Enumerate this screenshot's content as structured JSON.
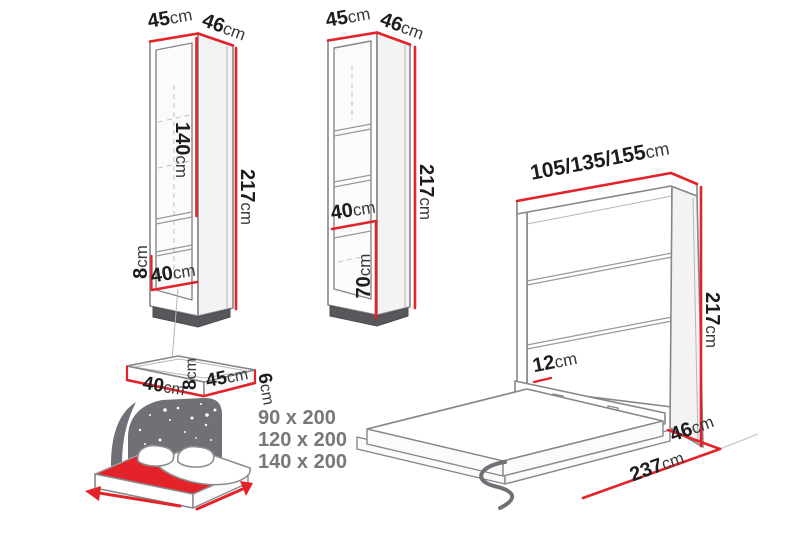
{
  "diagram_title": "wall-bed-and-cabinets-dimensions",
  "colors": {
    "dimension_red": "#e32329",
    "outline_gray": "#85878a",
    "text_dark": "#1d1d1f",
    "headboard_gray": "#6f7176",
    "size_list_gray": "#77787b"
  },
  "labels": {
    "cabinet_closed": {
      "top_width": {
        "value": "45",
        "unit": "cm"
      },
      "top_depth": {
        "value": "46",
        "unit": "cm"
      },
      "inner_height": {
        "value": "140",
        "unit": "cm"
      },
      "height": {
        "value": "217",
        "unit": "cm"
      },
      "base_height": {
        "value": "8",
        "unit": "cm"
      },
      "inner_width": {
        "value": "40",
        "unit": "cm"
      }
    },
    "cabinet_open": {
      "top_width": {
        "value": "45",
        "unit": "cm"
      },
      "top_depth": {
        "value": "46",
        "unit": "cm"
      },
      "height": {
        "value": "217",
        "unit": "cm"
      },
      "shelf_width": {
        "value": "40",
        "unit": "cm"
      },
      "lower_height": {
        "value": "70",
        "unit": "cm"
      }
    },
    "wall_bed": {
      "widths": {
        "value": "105/135/155",
        "unit": "cm"
      },
      "height": {
        "value": "217",
        "unit": "cm"
      },
      "rail_height": {
        "value": "12",
        "unit": "cm"
      },
      "depth": {
        "value": "46",
        "unit": "cm"
      },
      "open_depth": {
        "value": "237",
        "unit": "cm"
      }
    },
    "shelf": {
      "width": {
        "value": "40",
        "unit": "cm"
      },
      "height": {
        "value": "8",
        "unit": "cm"
      },
      "depth": {
        "value": "45",
        "unit": "cm"
      },
      "side_height": {
        "value": "6",
        "unit": "cm"
      }
    },
    "mattress_sizes": [
      "90 x 200",
      "120 x 200",
      "140 x 200"
    ]
  }
}
